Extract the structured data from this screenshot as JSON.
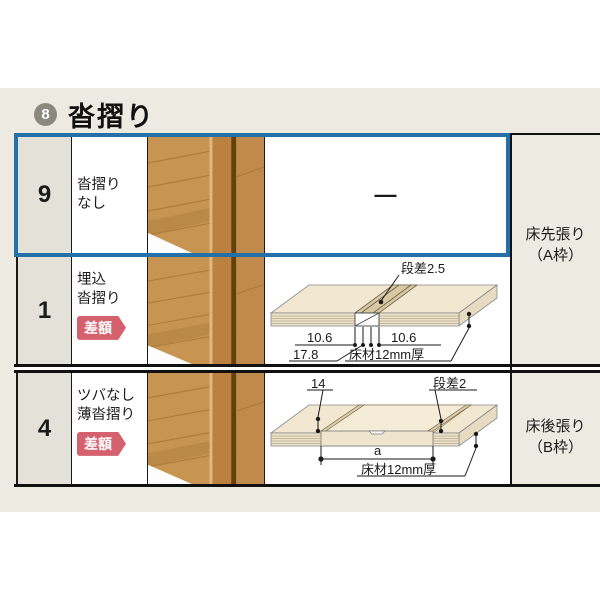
{
  "header": {
    "section_number": "8",
    "title": "沓摺り"
  },
  "rows": [
    {
      "num": "9",
      "label1": "沓摺り",
      "label2": "なし",
      "dash": "—"
    },
    {
      "num": "1",
      "label1": "埋込",
      "label2": "沓摺り",
      "badge": "差額"
    },
    {
      "num": "4",
      "label1": "ツバなし",
      "label2": "薄沓摺り",
      "badge": "差額"
    }
  ],
  "diagram_flush": {
    "step": "段差2.5",
    "left": "10.6",
    "right": "10.6",
    "total": "17.8",
    "floor": "床材12mm厚"
  },
  "diagram_thin": {
    "edge": "14",
    "step": "段差2",
    "span": "a",
    "floor": "床材12mm厚"
  },
  "side_labels": {
    "a1": "床先張り",
    "a2": "（A枠）",
    "b1": "床後張り",
    "b2": "（B枠）"
  },
  "colors": {
    "highlight_blue": "#2470A8",
    "badge_pink": "#D5606E",
    "panel_beige": "#ECEAE1",
    "number_cell": "#E3E1D8",
    "wood_mid": "#C79452",
    "wood_dark": "#64400F"
  }
}
